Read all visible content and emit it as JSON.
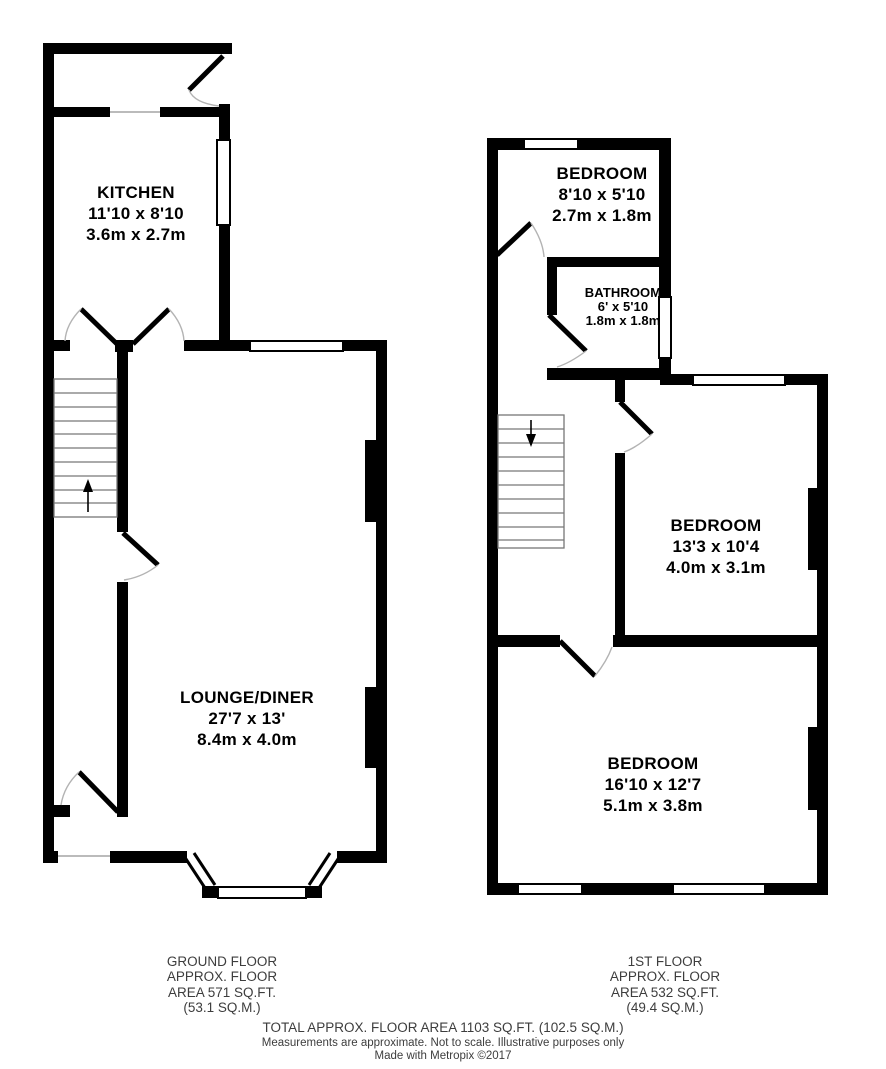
{
  "ground_floor": {
    "rooms": [
      {
        "name": "KITCHEN",
        "imperial": "11'10 x 8'10",
        "metric": "3.6m x 2.7m"
      },
      {
        "name": "LOUNGE/DINER",
        "imperial": "27'7 x 13'",
        "metric": "8.4m x 4.0m"
      }
    ],
    "area_lines": [
      "GROUND FLOOR",
      "APPROX. FLOOR",
      "AREA 571 SQ.FT.",
      "(53.1 SQ.M.)"
    ]
  },
  "first_floor": {
    "rooms": [
      {
        "name": "BEDROOM",
        "imperial": "8'10 x 5'10",
        "metric": "2.7m x 1.8m"
      },
      {
        "name": "BATHROOM",
        "imperial": "6' x 5'10",
        "metric": "1.8m x 1.8m"
      },
      {
        "name": "BEDROOM",
        "imperial": "13'3 x 10'4",
        "metric": "4.0m x 3.1m"
      },
      {
        "name": "BEDROOM",
        "imperial": "16'10 x 12'7",
        "metric": "5.1m x 3.8m"
      }
    ],
    "area_lines": [
      "1ST FLOOR",
      "APPROX. FLOOR",
      "AREA 532 SQ.FT.",
      "(49.4 SQ.M.)"
    ]
  },
  "footer": {
    "total": "TOTAL APPROX. FLOOR AREA 1103 SQ.FT. (102.5 SQ.M.)",
    "disclaimer": "Measurements are approximate.  Not to scale.  Illustrative purposes only",
    "credit": "Made with Metropix ©2017"
  },
  "colors": {
    "wall": "#000000",
    "window_fill": "#ffffff",
    "door_arc": "#b3b3b3",
    "stair_line": "#777777",
    "footer_text": "#3d3d3d"
  }
}
